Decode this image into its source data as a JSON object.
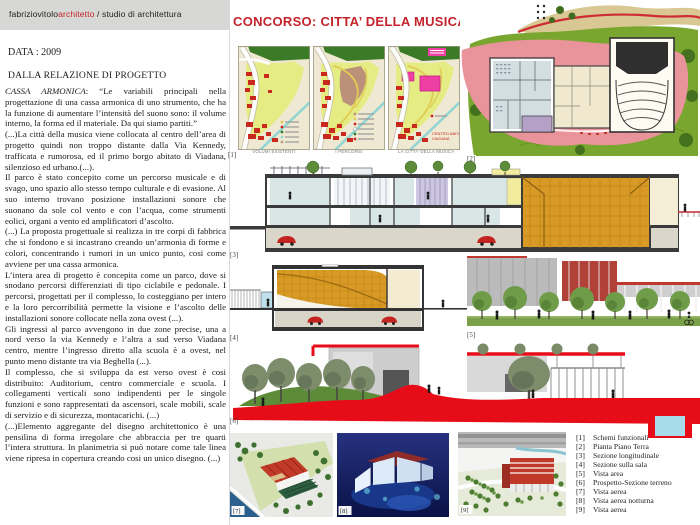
{
  "header": {
    "studio_black": "fabriziovitolo",
    "studio_red": "architetto",
    "studio_suffix": " / studio di architettura"
  },
  "title": "CONCORSO: CITTA’ DELLA MUSICA DI VIADANA",
  "meta": {
    "data_label": "DATA : 2009",
    "section_heading": "DALLA RELAZIONE DI PROGETTO"
  },
  "relazione": {
    "lead_italic": "CASSA ARMONICA",
    "lead_rest": ": “Le variabili principali nella progettazione di una cassa armonica di uno strumento, che ha la funzione di aumentare l’intensità del suono sono: il volume interno, la forma ed il materiale. Da qui siamo partiti.”",
    "paragraphs": [
      "(...)La città della musica viene collocata al centro dell’area di progetto quindi non troppo distante dalla Via Kennedy, trafficata e rumorosa, ed il primo borgo abitato di Viadana, silenzioso ed urbano.(...).",
      "Il parco è stato concepito come un percorso musicale e di svago, uno spazio allo stesso tempo culturale e di evasione. Al suo interno  trovano posizione installazioni sonore che suonano da sole col vento e  con l’acqua, come strumenti eolici, organi a vento ed amplificatori d’ascolto.",
      "(...) La proposta progettuale si realizza in tre corpi di fabbrica che si fondono e si incastrano creando un’armonia di forme e colori, concentrando i rumori in un unico punto, cosi come avviene per una cassa armonica.",
      "L’intera area di progetto è concepita come un parco, dove si snodano percorsi differenziati  di tipo ciclabile e pedonale. I percorsi, progettati per il complesso, lo costeggiano per intero e la loro percorribilità permette la visione e l’ascolto delle installazioni sonore collocate nella zona ovest (...).",
      "Gli ingressi al parco avvengono in due zone precise, una a nord verso la via Kennedy e l’altra a sud verso Viadana centro, mentre l’ingresso diretto alla scuola è a ovest, nel punto meno distante tra via Beghella (...).",
      "Il complesso, che si sviluppa da est verso ovest è cosi distribuito: Auditorium, centro commerciale e scuola. I collegamenti verticali sono indipendenti per le singole funzioni e sono rappresentati da ascensori, scale mobili, scale di servizio e di sicurezza, montacarichi. (...)",
      "(...)Elemento aggregante del disegno architettonico è una pensilina di forma irregolare che abbraccia per tre quarti l’intera struttura. In planimetria si può notare come tale linea viene ripresa in copertura creando cosi un unico disegno. (...)"
    ]
  },
  "maps": {
    "captions": [
      "VOLUMI ESISTENTI",
      "I PERCORSI",
      "LA CITTA’ DELLA MUSICA"
    ],
    "annotation_line1": "CENTRO ABITATO",
    "annotation_line2": "VIADANA"
  },
  "figures": {
    "tags": [
      "[1]",
      "[2]",
      "[3]",
      "[4]",
      "[5]",
      "[6]",
      "[7]",
      "[8]",
      "[9]"
    ]
  },
  "legend": {
    "items": [
      {
        "num": "[1]",
        "label": "Schemi funzionali"
      },
      {
        "num": "[2]",
        "label": "Pianta Piano Terra"
      },
      {
        "num": "[3]",
        "label": "Sezione longitudinale"
      },
      {
        "num": "[4]",
        "label": "Sezione sulla sala"
      },
      {
        "num": "[5]",
        "label": "Vista area"
      },
      {
        "num": "[6]",
        "label": "Prospetto-Sezione terreno"
      },
      {
        "num": "[7]",
        "label": "Vista aerea"
      },
      {
        "num": "[8]",
        "label": "Vista aerea notturna"
      },
      {
        "num": "[9]",
        "label": "Vista aerea"
      }
    ]
  },
  "colors": {
    "accent_red": "#c5232b",
    "bright_red": "#e60d18",
    "gold": "#d89a25",
    "plaza_pink": "#e9939b",
    "lawn_green": "#79a62e",
    "water_blue": "#a8dcec",
    "night_navy": "#131f60"
  }
}
